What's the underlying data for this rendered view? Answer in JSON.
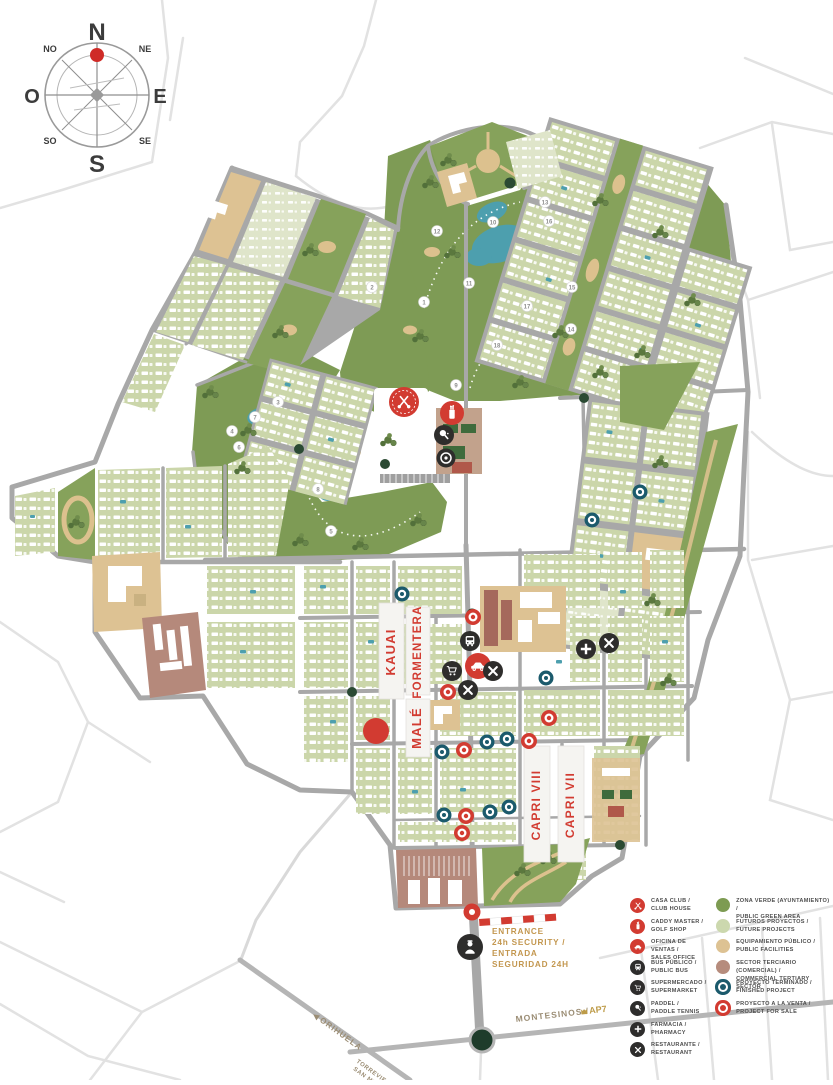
{
  "compass": {
    "n": "N",
    "ne": "NE",
    "e": "E",
    "se": "SE",
    "s": "S",
    "so": "SO",
    "o": "O",
    "no": "NO"
  },
  "map": {
    "district_labels": {
      "kauai": "KAUAI",
      "formentera": "FORMENTERA",
      "male": "MALÉ",
      "capri8": "CAPRI VIII",
      "capri7": "CAPRI VII"
    },
    "golf_holes": [
      "1",
      "2",
      "3",
      "4",
      "5",
      "6",
      "7",
      "8",
      "9",
      "10",
      "11",
      "12",
      "13",
      "14",
      "15",
      "16",
      "17",
      "18"
    ]
  },
  "entrance": {
    "line1": "ENTRANCE",
    "line2": "24h SECURITY /",
    "line3": "ENTRADA",
    "line4": "SEGURIDAD 24H"
  },
  "roads": {
    "orihuela": "ORIHUELA",
    "orihuela_arrow": "◀",
    "torrevieja": "TORREVIEJA",
    "san_miguel": "SAN MIGUEL",
    "montesinos": "MONTESINOS /",
    "ap7": "AP7"
  },
  "legend": {
    "services": [
      {
        "icon": "golf-clubs-icon",
        "label_es": "CASA CLUB /",
        "label_en": "CLUB HOUSE"
      },
      {
        "icon": "golf-bag-icon",
        "label_es": "CADDY MASTER /",
        "label_en": "GOLF SHOP"
      },
      {
        "icon": "car-icon",
        "label_es": "OFICINA DE VENTAS /",
        "label_en": "SALES OFFICE"
      },
      {
        "icon": "bus-icon",
        "label_es": "BUS PÚBLICO /",
        "label_en": "PUBLIC BUS"
      },
      {
        "icon": "cart-icon",
        "label_es": "SUPERMERCADO /",
        "label_en": "SUPERMARKET"
      },
      {
        "icon": "paddle-icon",
        "label_es": "PADDEL /",
        "label_en": "PADDLE TENNIS"
      },
      {
        "icon": "cross-icon",
        "label_es": "FARMACIA /",
        "label_en": "PHARMACY"
      },
      {
        "icon": "cutlery-icon",
        "label_es": "RESTAURANTE /",
        "label_en": "RESTAURANT"
      }
    ],
    "zones": [
      {
        "swatch": "#7d9b52",
        "label_es": "ZONA VERDE (AYUNTAMIENTO) /",
        "label_en": "PUBLIC GREEN AREA"
      },
      {
        "swatch": "#ccd8ae",
        "label_es": "FUTUROS PROYECTOS /",
        "label_en": "FUTURE PROJECTS"
      },
      {
        "swatch": "#ddc293",
        "label_es": "EQUIPAMIENTO PÚBLICO /",
        "label_en": "PUBLIC FACILITIES"
      },
      {
        "swatch": "#b68c7d",
        "label_es": "SECTOR TERCIARIO (COMERCIAL) /",
        "label_en": "COMMERCIAL TERTIARY SECTOR"
      },
      {
        "swatch": "#1b5a6c",
        "label_es": "PROYECTO TERMINADO /",
        "label_en": "FINISHED PROJECT"
      },
      {
        "swatch": "#d23b31",
        "label_es": "PROYECTO A LA VENTA /",
        "label_en": "PROJECT FOR SALE"
      }
    ]
  },
  "colors": {
    "accent_red": "#d23b31",
    "finished_teal": "#1b5a6c",
    "golf_green": "#7e9b55",
    "residential_green": "#ccd8ae",
    "sand": "#dcc18e",
    "public_tan": "#ddc293",
    "tertiary_brown": "#b68c7d",
    "road_gray": "#a8a8a8",
    "lake_blue": "#4d9fae",
    "gold_label": "#c3974f"
  }
}
